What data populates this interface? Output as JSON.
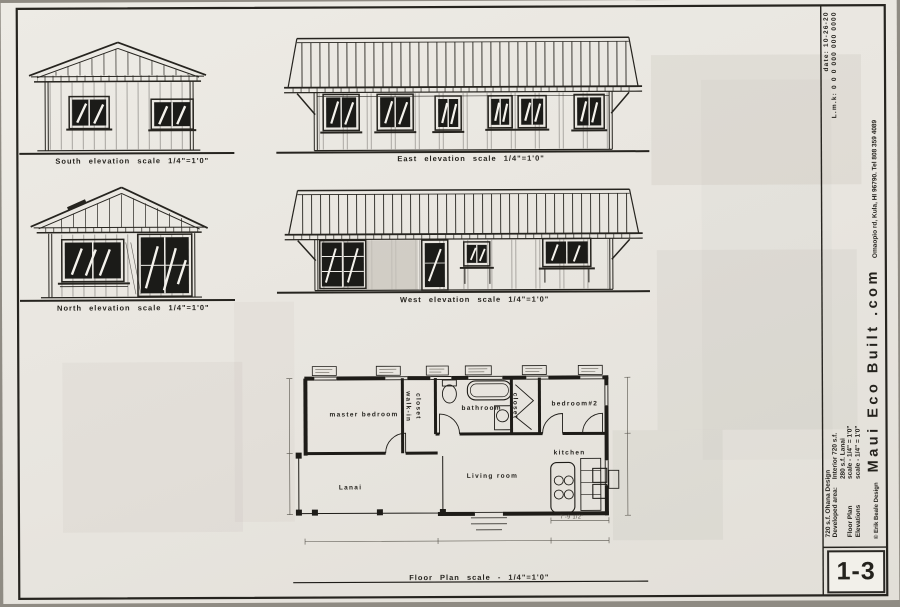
{
  "sheet": {
    "number": "1-3",
    "floor_plan_label": "Floor Plan scale - 1/4\"=1'0\"",
    "elevations": {
      "south": "South elevation scale 1/4\"=1'0\"",
      "east": "East elevation scale 1/4\"=1'0\"",
      "north": "North elevation scale 1/4\"=1'0\"",
      "west": "West elevation scale 1/4\"=1'0\""
    },
    "rooms": {
      "master": "master bedroom",
      "walk_in": "walk-in",
      "walk_in_closet": "closet",
      "bathroom": "bathroom",
      "closet2": "closet",
      "bedroom2": "bedroom#2",
      "kitchen": "kitchen",
      "living": "Living room",
      "lanai": "Lanai"
    },
    "dimensions": {
      "kitchen_width": "7'-9 1/2\""
    }
  },
  "title_block": {
    "design_title": "720 s.f. Ohana Design",
    "developed_area_label": "Developed area:",
    "interior_area": "Interior 720 s.f.",
    "lanai_area": "280 s.f. Lanai",
    "floor_plan_label": "Floor Plan",
    "floor_plan_scale": "scale - 1/4\" = 1'0\"",
    "elevations_label": "Elevations",
    "elevations_scale": "scale - 1/4\" = 1'0\"",
    "copyright": "© Erik Beale Design",
    "company": "Maui Eco Built .com",
    "address": "Omaopio rd, Kula, HI 96790.  Tel 808 359 4089",
    "date": "date: 10-26-20",
    "lmk": "L.m.k: 0 0 0 000 000 0000"
  },
  "colors": {
    "paper": "#e9e6e0",
    "ink": "#26241f",
    "glass": "#1b1b18"
  }
}
